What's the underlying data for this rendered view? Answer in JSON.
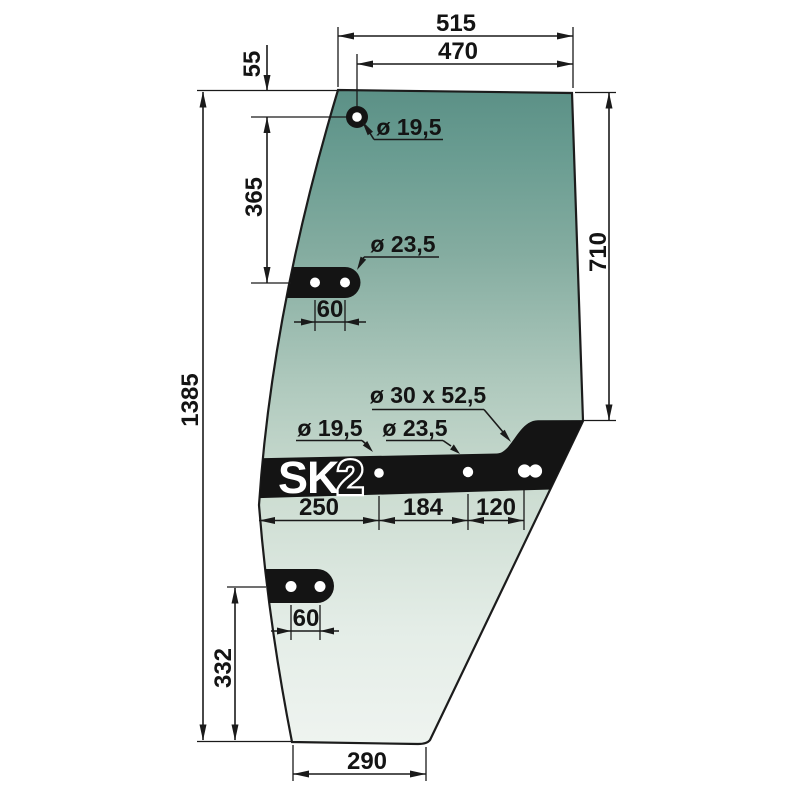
{
  "drawing": {
    "logo": {
      "brand": "SK",
      "model": "2"
    },
    "colors": {
      "glass_top": "#5b9086",
      "glass_mid": "#afc9bd",
      "glass_bottom": "#eff4f0",
      "band": "#141414",
      "line": "#1a1a1a",
      "hole": "#ffffff"
    },
    "dims": {
      "width_top_outer": "515",
      "width_top_to_hole": "470",
      "hole_top_offset": "55",
      "hole_to_bracket": "365",
      "height_right": "710",
      "height_total": "1385",
      "bracket_to_bottom": "332",
      "width_bottom": "290",
      "band_seg_left": "250",
      "band_seg_mid": "184",
      "band_seg_right": "120",
      "upper_bracket_hole_spacing": "60",
      "lower_bracket_hole_spacing": "60"
    },
    "hole_labels": {
      "top_hole": "ø 19,5",
      "upper_bracket_hole": "ø 23,5",
      "band_slot": "ø 30 x 52,5",
      "band_hole_left": "ø 19,5",
      "band_hole_mid": "ø 23,5"
    }
  }
}
